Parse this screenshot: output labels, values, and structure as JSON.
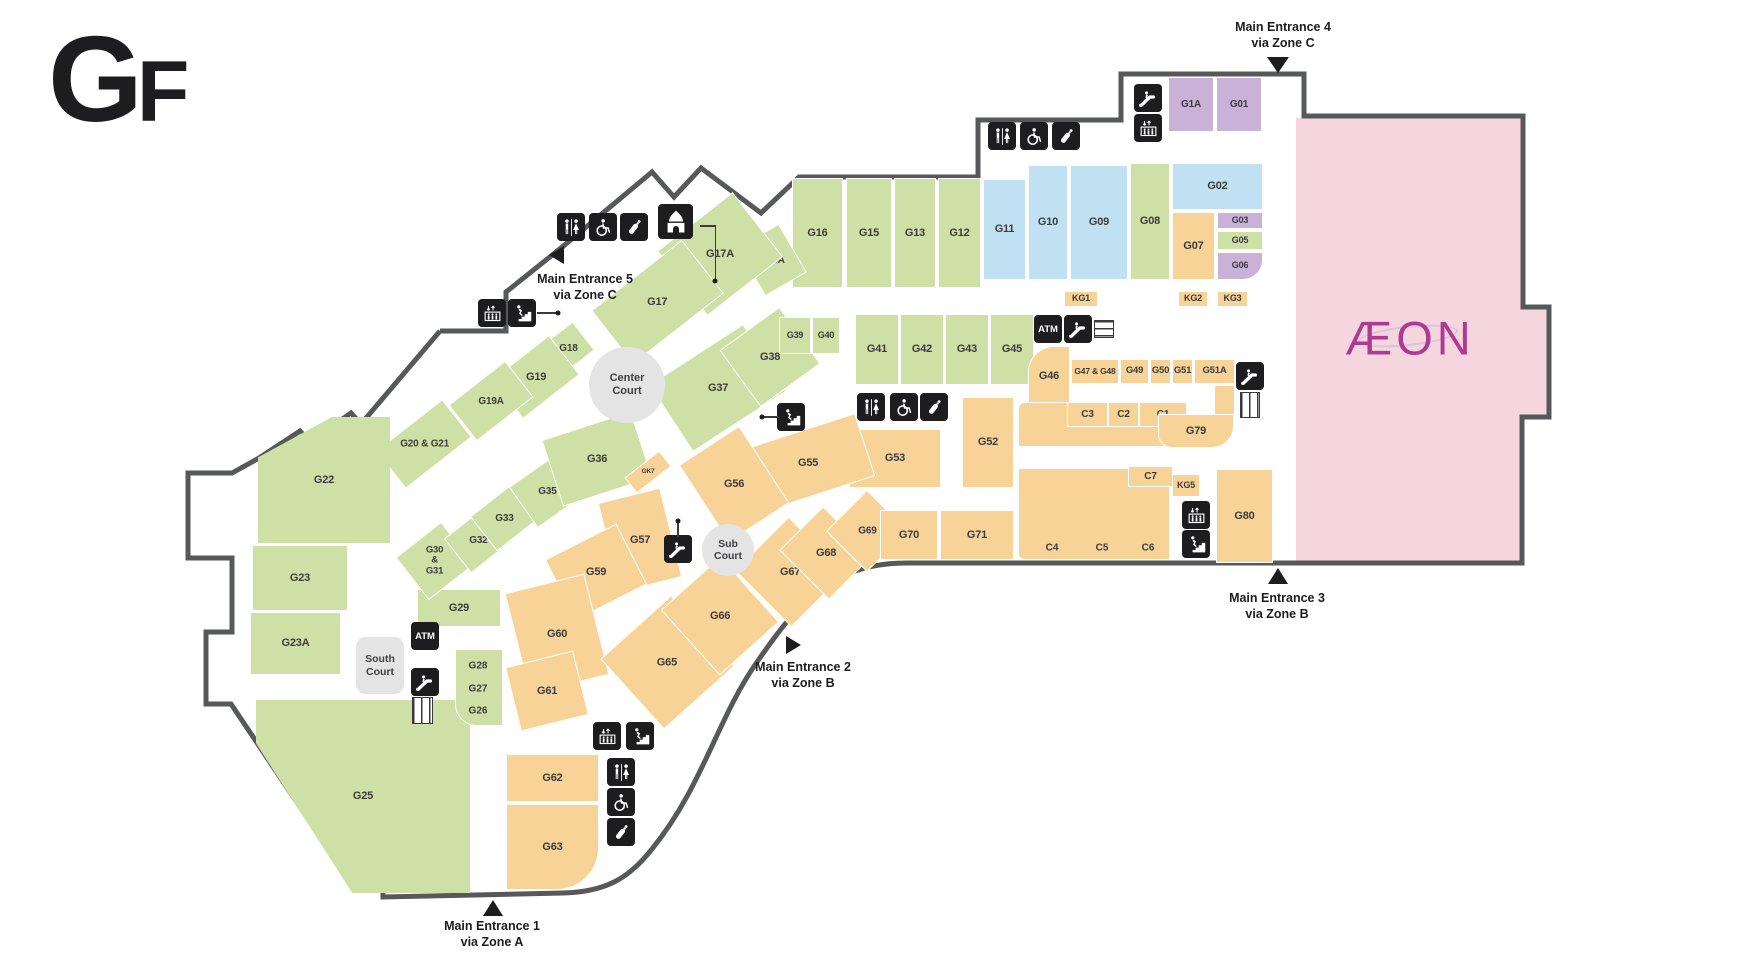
{
  "title": "GF",
  "palette": {
    "g": "#cfe0a6",
    "b": "#bfe1f2",
    "o": "#f7d398",
    "p": "#c9b1d8",
    "pink": "#f6d6de",
    "court": "#e4e4e5",
    "wall": "#57585a",
    "icon_bg": "#1d1d1f",
    "label": "#3c3c3e",
    "aeon_magenta": "#ae3a94"
  },
  "anchor_store": {
    "label": "ÆON"
  },
  "building": {
    "outline_path": "M 440,331 L 506,331 L 506,292 L 561,248 L 652,172 L 674,197 L 701,168 L 761,213 L 799,177 L 978,177 L 978,120 L 1121,120 L 1121,74 L 1304,74 L 1304,116 L 1523,116 L 1523,307 L 1549,307 L 1549,417 L 1522,417 L 1522,563 L 906,563 C 828,563 794,609 757,662 C 717,719 703,786 652,849 C 630,877 607,892 563,893 L 383,897 L 383,871 L 343,871 L 231,704 L 206,704 L 206,632 L 232,632 L 232,558 L 188,558 L 188,473 L 232,473 L 259,458 L 300,431 L 310,442 L 351,413 L 361,424 L 440,331"
  },
  "rooms": [
    {
      "id": "G1A",
      "x": 1168,
      "y": 77,
      "w": 46,
      "h": 55,
      "c": "p",
      "fs": 10
    },
    {
      "id": "G01",
      "x": 1216,
      "y": 77,
      "w": 46,
      "h": 55,
      "c": "p",
      "fs": 10
    },
    {
      "id": "G02",
      "x": 1172,
      "y": 163,
      "w": 91,
      "h": 47,
      "c": "b"
    },
    {
      "id": "G03",
      "x": 1217,
      "y": 212,
      "w": 46,
      "h": 17,
      "c": "p",
      "fs": 9
    },
    {
      "id": "G05",
      "x": 1217,
      "y": 231,
      "w": 46,
      "h": 19,
      "c": "g",
      "fs": 9
    },
    {
      "id": "G06",
      "x": 1217,
      "y": 252,
      "w": 46,
      "h": 28,
      "c": "p",
      "fs": 9,
      "br": "0 0 20px 0"
    },
    {
      "id": "G07",
      "x": 1172,
      "y": 212,
      "w": 43,
      "h": 68,
      "c": "o"
    },
    {
      "id": "G08",
      "x": 1130,
      "y": 163,
      "w": 40,
      "h": 117,
      "c": "g"
    },
    {
      "id": "G09",
      "x": 1070,
      "y": 165,
      "w": 58,
      "h": 115,
      "c": "b"
    },
    {
      "id": "G10",
      "x": 1028,
      "y": 165,
      "w": 40,
      "h": 115,
      "c": "b"
    },
    {
      "id": "G11",
      "x": 983,
      "y": 179,
      "w": 43,
      "h": 101,
      "c": "b"
    },
    {
      "id": "G12",
      "x": 938,
      "y": 178,
      "w": 43,
      "h": 110,
      "c": "g"
    },
    {
      "id": "G13",
      "x": 894,
      "y": 178,
      "w": 42,
      "h": 110,
      "c": "g"
    },
    {
      "id": "G15",
      "x": 846,
      "y": 178,
      "w": 46,
      "h": 110,
      "c": "g"
    },
    {
      "id": "G16",
      "x": 792,
      "y": 178,
      "w": 51,
      "h": 110,
      "c": "g"
    },
    {
      "id": "G16A",
      "x": 748,
      "y": 232,
      "w": 48,
      "h": 56,
      "c": "g",
      "rot": -30,
      "fs": 10
    },
    {
      "id": "G17A",
      "x": 672,
      "y": 213,
      "w": 96,
      "h": 82,
      "c": "g",
      "rot": -38
    },
    {
      "id": "G17",
      "x": 600,
      "y": 268,
      "w": 115,
      "h": 68,
      "c": "g",
      "rot": -38
    },
    {
      "id": "G18",
      "x": 548,
      "y": 330,
      "w": 40,
      "h": 36,
      "c": "g",
      "rot": -38,
      "fs": 10
    },
    {
      "id": "G19",
      "x": 500,
      "y": 352,
      "w": 72,
      "h": 50,
      "c": "g",
      "rot": -38
    },
    {
      "id": "G19A",
      "x": 455,
      "y": 378,
      "w": 72,
      "h": 46,
      "c": "g",
      "rot": -38,
      "fs": 10
    },
    {
      "id": "G20-21",
      "label": "G20 & G21",
      "x": 382,
      "y": 420,
      "w": 84,
      "h": 48,
      "c": "g",
      "rot": -38,
      "fs": 10
    },
    {
      "id": "G22",
      "x": 258,
      "y": 417,
      "w": 132,
      "h": 126,
      "c": "g",
      "clip": "polygon(0 32%, 56% 0, 100% 0, 100% 100%, 0 100%)"
    },
    {
      "id": "G23",
      "x": 252,
      "y": 545,
      "w": 96,
      "h": 66,
      "c": "g"
    },
    {
      "id": "G23A",
      "x": 250,
      "y": 612,
      "w": 91,
      "h": 63,
      "c": "g"
    },
    {
      "id": "G25",
      "x": 256,
      "y": 700,
      "w": 214,
      "h": 193,
      "c": "g",
      "clip": "polygon(-13% 0, 100% 0, 100% 100%, 45% 100%)"
    },
    {
      "id": "G29",
      "x": 417,
      "y": 589,
      "w": 84,
      "h": 38,
      "c": "g"
    },
    {
      "id": "G26-28",
      "label": "",
      "x": 455,
      "y": 649,
      "w": 48,
      "h": 77,
      "c": "g",
      "br": "0 0 0 22px",
      "nolabel": true
    },
    {
      "id": "G30-31",
      "label": "G30\n&\nG31",
      "x": 406,
      "y": 534,
      "w": 58,
      "h": 54,
      "c": "g",
      "rot": -38,
      "fs": 9.5
    },
    {
      "id": "G32",
      "x": 452,
      "y": 518,
      "w": 52,
      "h": 44,
      "c": "g",
      "rot": -38,
      "fs": 10
    },
    {
      "id": "G33",
      "x": 478,
      "y": 496,
      "w": 52,
      "h": 44,
      "c": "g",
      "rot": -38,
      "fs": 10
    },
    {
      "id": "G35",
      "x": 518,
      "y": 466,
      "w": 58,
      "h": 50,
      "c": "g",
      "rot": -35,
      "fs": 10
    },
    {
      "id": "G36",
      "x": 550,
      "y": 424,
      "w": 94,
      "h": 70,
      "c": "g",
      "rot": -18
    },
    {
      "id": "G37",
      "x": 662,
      "y": 348,
      "w": 112,
      "h": 80,
      "c": "g",
      "rot": -33
    },
    {
      "id": "G38",
      "x": 733,
      "y": 322,
      "w": 74,
      "h": 70,
      "c": "g",
      "rot": -36
    },
    {
      "id": "G39",
      "x": 779,
      "y": 317,
      "w": 32,
      "h": 37,
      "c": "g",
      "fs": 9
    },
    {
      "id": "G40",
      "x": 812,
      "y": 317,
      "w": 28,
      "h": 37,
      "c": "g",
      "fs": 9
    },
    {
      "id": "G41",
      "x": 855,
      "y": 314,
      "w": 44,
      "h": 71,
      "c": "g"
    },
    {
      "id": "G42",
      "x": 900,
      "y": 314,
      "w": 44,
      "h": 71,
      "c": "g"
    },
    {
      "id": "G43",
      "x": 945,
      "y": 314,
      "w": 44,
      "h": 71,
      "c": "g"
    },
    {
      "id": "G45",
      "x": 990,
      "y": 314,
      "w": 44,
      "h": 71,
      "c": "g"
    },
    {
      "id": "KG1",
      "x": 1064,
      "y": 291,
      "w": 34,
      "h": 16,
      "c": "o",
      "fs": 9
    },
    {
      "id": "KG2",
      "x": 1178,
      "y": 291,
      "w": 30,
      "h": 16,
      "c": "o",
      "fs": 9
    },
    {
      "id": "KG3",
      "x": 1217,
      "y": 291,
      "w": 31,
      "h": 16,
      "c": "o",
      "fs": 9
    },
    {
      "id": "G46",
      "x": 1028,
      "y": 346,
      "w": 42,
      "h": 60,
      "c": "o",
      "br": "26px 0 0 0"
    },
    {
      "id": "G47-48",
      "label": "G47 & G48",
      "x": 1071,
      "y": 359,
      "w": 48,
      "h": 25,
      "c": "o",
      "fs": 8.5
    },
    {
      "id": "G49",
      "x": 1120,
      "y": 359,
      "w": 29,
      "h": 25,
      "c": "o",
      "fs": 9.5
    },
    {
      "id": "G50",
      "x": 1150,
      "y": 359,
      "w": 21,
      "h": 25,
      "c": "o",
      "fs": 9.5
    },
    {
      "id": "G51",
      "x": 1172,
      "y": 359,
      "w": 21,
      "h": 25,
      "c": "o",
      "fs": 9.5
    },
    {
      "id": "G51A",
      "x": 1194,
      "y": 359,
      "w": 41,
      "h": 25,
      "c": "o",
      "fs": 9.5
    },
    {
      "id": "G51A-stub",
      "label": "",
      "x": 1214,
      "y": 385,
      "w": 21,
      "h": 31,
      "c": "o",
      "nolabel": true
    },
    {
      "id": "bigC",
      "label": "",
      "x": 1018,
      "y": 402,
      "w": 152,
      "h": 158,
      "c": "o",
      "br": "6px 26px 2px 6px",
      "nolabel": true
    },
    {
      "id": "corridorC",
      "label": "",
      "x": 1012,
      "y": 446,
      "w": 224,
      "h": 23,
      "c": "white",
      "br": "0 18px 18px 0",
      "nolabel": true,
      "white": true
    },
    {
      "id": "C3",
      "x": 1067,
      "y": 402,
      "w": 41,
      "h": 25,
      "c": "o",
      "fs": 10
    },
    {
      "id": "C2",
      "x": 1108,
      "y": 402,
      "w": 31,
      "h": 25,
      "c": "o",
      "fs": 10
    },
    {
      "id": "C1",
      "x": 1139,
      "y": 402,
      "w": 48,
      "h": 25,
      "c": "o",
      "fs": 10
    },
    {
      "id": "G79",
      "x": 1158,
      "y": 414,
      "w": 76,
      "h": 34,
      "c": "o",
      "br": "0 0 22px 14px"
    },
    {
      "id": "C7",
      "x": 1128,
      "y": 466,
      "w": 45,
      "h": 21,
      "c": "o",
      "fs": 10
    },
    {
      "id": "KG5",
      "x": 1172,
      "y": 474,
      "w": 28,
      "h": 23,
      "c": "o",
      "fs": 9
    },
    {
      "id": "G80",
      "x": 1216,
      "y": 469,
      "w": 57,
      "h": 94,
      "c": "o"
    },
    {
      "id": "G52",
      "x": 962,
      "y": 397,
      "w": 52,
      "h": 91,
      "c": "o"
    },
    {
      "id": "G53",
      "x": 849,
      "y": 429,
      "w": 92,
      "h": 59,
      "c": "o"
    },
    {
      "id": "G55",
      "x": 748,
      "y": 430,
      "w": 120,
      "h": 66,
      "c": "o",
      "rot": -18
    },
    {
      "id": "G56",
      "x": 698,
      "y": 438,
      "w": 72,
      "h": 92,
      "c": "o",
      "rot": -33
    },
    {
      "id": "GK7",
      "x": 626,
      "y": 462,
      "w": 44,
      "h": 20,
      "c": "o",
      "rot": -38,
      "fs": 6.5
    },
    {
      "id": "G57",
      "x": 608,
      "y": 494,
      "w": 64,
      "h": 92,
      "c": "o",
      "rot": -14
    },
    {
      "id": "G59",
      "x": 556,
      "y": 538,
      "w": 80,
      "h": 68,
      "c": "o",
      "rot": -27
    },
    {
      "id": "G60",
      "x": 516,
      "y": 582,
      "w": 82,
      "h": 104,
      "c": "o",
      "rot": -14
    },
    {
      "id": "G61",
      "x": 512,
      "y": 658,
      "w": 70,
      "h": 66,
      "c": "o",
      "rot": -14
    },
    {
      "id": "G62",
      "x": 506,
      "y": 754,
      "w": 93,
      "h": 48,
      "c": "o"
    },
    {
      "id": "G63",
      "x": 506,
      "y": 804,
      "w": 93,
      "h": 86,
      "c": "o",
      "br": "0 0 42px 0"
    },
    {
      "id": "G65",
      "x": 620,
      "y": 615,
      "w": 95,
      "h": 95,
      "c": "o",
      "rot": -42
    },
    {
      "id": "G66",
      "x": 680,
      "y": 572,
      "w": 80,
      "h": 88,
      "c": "o",
      "rot": -42
    },
    {
      "id": "G67",
      "x": 752,
      "y": 532,
      "w": 76,
      "h": 80,
      "c": "o",
      "rot": -45
    },
    {
      "id": "G68",
      "x": 795,
      "y": 518,
      "w": 62,
      "h": 70,
      "c": "o",
      "rot": -45
    },
    {
      "id": "G69",
      "x": 838,
      "y": 502,
      "w": 58,
      "h": 58,
      "c": "o",
      "rot": -45,
      "fs": 10
    },
    {
      "id": "G70",
      "x": 880,
      "y": 510,
      "w": 58,
      "h": 50,
      "c": "o"
    },
    {
      "id": "G71",
      "x": 940,
      "y": 510,
      "w": 74,
      "h": 50,
      "c": "o"
    }
  ],
  "texts": [
    {
      "t": "C4",
      "x": 1052,
      "y": 548,
      "fs": 10
    },
    {
      "t": "C5",
      "x": 1102,
      "y": 548,
      "fs": 10
    },
    {
      "t": "C6",
      "x": 1148,
      "y": 548,
      "fs": 10
    },
    {
      "t": "G28",
      "x": 478,
      "y": 666,
      "fs": 10
    },
    {
      "t": "G27",
      "x": 478,
      "y": 689,
      "fs": 10
    },
    {
      "t": "G26",
      "x": 478,
      "y": 711,
      "fs": 10
    }
  ],
  "courts": [
    {
      "name": "center-court",
      "shape": "circle",
      "x": 589,
      "y": 347,
      "w": 76,
      "h": 76,
      "lines": [
        "Center",
        "Court"
      ],
      "fs": 11
    },
    {
      "name": "sub-court",
      "shape": "circle",
      "x": 702,
      "y": 524,
      "w": 52,
      "h": 52,
      "lines": [
        "Sub",
        "Court"
      ],
      "fs": 10.5
    },
    {
      "name": "south-court",
      "shape": "rect",
      "x": 356,
      "y": 637,
      "w": 48,
      "h": 57,
      "lines": [
        "South",
        "Court"
      ],
      "fs": 10.5
    }
  ],
  "icons": [
    {
      "type": "escalator",
      "x": 1134,
      "y": 84
    },
    {
      "type": "elevator",
      "x": 1134,
      "y": 114
    },
    {
      "type": "restroom",
      "x": 988,
      "y": 122
    },
    {
      "type": "wheelchair",
      "x": 1020,
      "y": 122
    },
    {
      "type": "nursing",
      "x": 1052,
      "y": 122
    },
    {
      "type": "restroom",
      "x": 557,
      "y": 213
    },
    {
      "type": "wheelchair",
      "x": 589,
      "y": 213
    },
    {
      "type": "nursing",
      "x": 620,
      "y": 213
    },
    {
      "type": "prayer",
      "x": 658,
      "y": 204,
      "s": 35
    },
    {
      "type": "elevator",
      "x": 478,
      "y": 299
    },
    {
      "type": "stairs",
      "x": 508,
      "y": 299
    },
    {
      "type": "atm",
      "x": 1034,
      "y": 315,
      "label": "ATM"
    },
    {
      "type": "escalator",
      "x": 1064,
      "y": 315
    },
    {
      "type": "restroom",
      "x": 857,
      "y": 393
    },
    {
      "type": "wheelchair",
      "x": 890,
      "y": 393
    },
    {
      "type": "nursing",
      "x": 920,
      "y": 393
    },
    {
      "type": "stairs",
      "x": 777,
      "y": 403
    },
    {
      "type": "escalator",
      "x": 1236,
      "y": 362
    },
    {
      "type": "escalator",
      "x": 664,
      "y": 535
    },
    {
      "type": "elevator",
      "x": 1182,
      "y": 501
    },
    {
      "type": "stairs",
      "x": 1182,
      "y": 530
    },
    {
      "type": "atm",
      "x": 411,
      "y": 622,
      "label": "ATM"
    },
    {
      "type": "escalator",
      "x": 411,
      "y": 668
    },
    {
      "type": "elevator",
      "x": 593,
      "y": 722
    },
    {
      "type": "stairs",
      "x": 626,
      "y": 722
    },
    {
      "type": "restroom",
      "x": 607,
      "y": 758
    },
    {
      "type": "wheelchair",
      "x": 607,
      "y": 788
    },
    {
      "type": "nursing",
      "x": 607,
      "y": 818
    }
  ],
  "shafts": [
    {
      "x": 1094,
      "y": 320,
      "w": 20,
      "h": 18,
      "dir": "h"
    },
    {
      "x": 1240,
      "y": 392,
      "w": 20,
      "h": 26,
      "dir": "v"
    },
    {
      "x": 412,
      "y": 697,
      "w": 21,
      "h": 27,
      "dir": "v"
    }
  ],
  "lines": [
    {
      "x": 700,
      "y": 225,
      "w": 16,
      "h": 1.5
    },
    {
      "x": 714.5,
      "y": 225,
      "w": 1.5,
      "h": 55
    },
    {
      "x": 537,
      "y": 312,
      "w": 20,
      "h": 1.5
    },
    {
      "x": 764,
      "y": 416,
      "w": 15,
      "h": 1.5
    },
    {
      "x": 677,
      "y": 523,
      "w": 1.5,
      "h": 14
    }
  ],
  "dots": [
    {
      "x": 715,
      "y": 281
    },
    {
      "x": 558,
      "y": 313
    },
    {
      "x": 762,
      "y": 417
    },
    {
      "x": 678,
      "y": 521
    }
  ],
  "entrances": [
    {
      "name": "main-entrance-4",
      "main": "Main Entrance 4",
      "sub": "via Zone C",
      "tx": 1283,
      "ty": 20,
      "dir": "down",
      "px": 1267,
      "py": 57
    },
    {
      "name": "main-entrance-5",
      "main": "Main Entrance 5",
      "sub": "via Zone C",
      "tx": 585,
      "ty": 272,
      "dir": "left",
      "px": 549,
      "py": 246
    },
    {
      "name": "main-entrance-1",
      "main": "Main Entrance 1",
      "sub": "via Zone A",
      "tx": 492,
      "ty": 919,
      "dir": "up",
      "px": 483,
      "py": 900
    },
    {
      "name": "main-entrance-2",
      "main": "Main Entrance 2",
      "sub": "via Zone B",
      "tx": 803,
      "ty": 660,
      "dir": "right",
      "px": 786,
      "py": 636
    },
    {
      "name": "main-entrance-3",
      "main": "Main Entrance 3",
      "sub": "via Zone B",
      "tx": 1277,
      "ty": 591,
      "dir": "up",
      "px": 1268,
      "py": 568
    }
  ]
}
